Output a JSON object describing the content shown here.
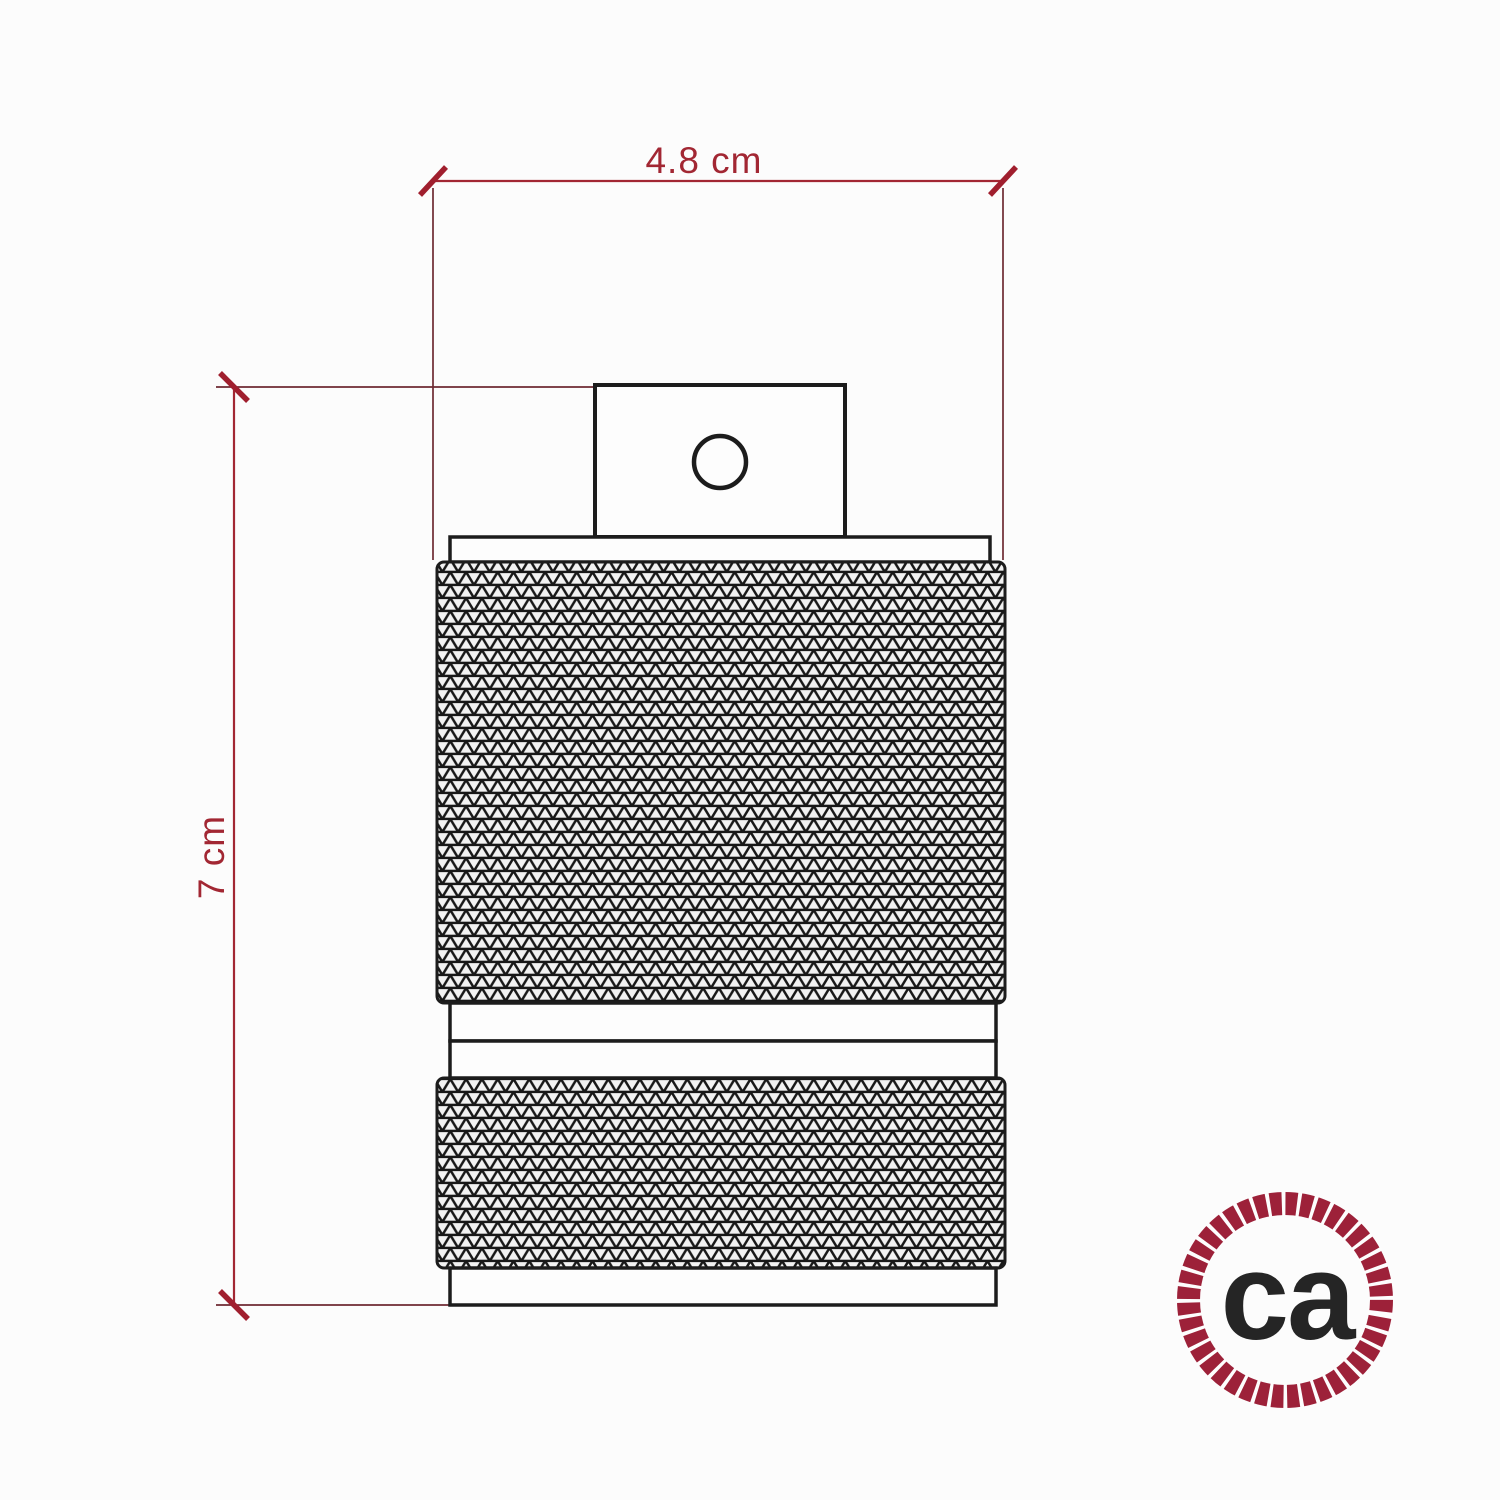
{
  "dimensions": {
    "width": {
      "label": "4.8 cm"
    },
    "height": {
      "label": "7 cm"
    },
    "accent_color": "#a22733"
  },
  "drawing": {
    "line_color": "#1c1c1c",
    "knurl_fill": "#f2f2f2"
  },
  "logo": {
    "text": "ca",
    "ring_color": "#9d2139",
    "text_color": "#252525"
  }
}
